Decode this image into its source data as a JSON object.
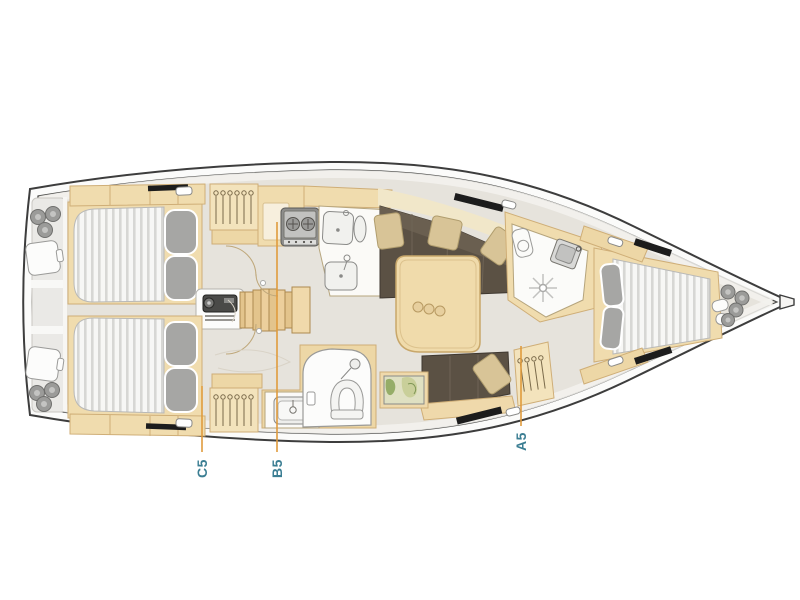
{
  "document": {
    "type": "sailing-yacht-interior-layout-plan",
    "orientation": "bow-right"
  },
  "plan": {
    "labels": [
      {
        "text": "C5"
      },
      {
        "text": "B5"
      },
      {
        "text": "A5"
      }
    ]
  },
  "colors": {
    "background": "#ffffff",
    "hull_outline": "#3d3d3d",
    "deck": "#fbfbfa",
    "interior_floor": "#e6e3dc",
    "cabinetry_wood": "#f0dcae",
    "cabinetry_wood_border": "#cfae77",
    "mattress": "#f7f7f5",
    "mattress_stripe": "#d7d7d4",
    "pillow_gray": "#a6a6a4",
    "sofa_brown": "#5b5144",
    "sofa_pillow_tan": "#d8c497",
    "stove_gray": "#8e8e8c",
    "leader_line_orange": "#e09b3d",
    "label_teal": "#3b7e93",
    "map_green": "#96ad68"
  }
}
